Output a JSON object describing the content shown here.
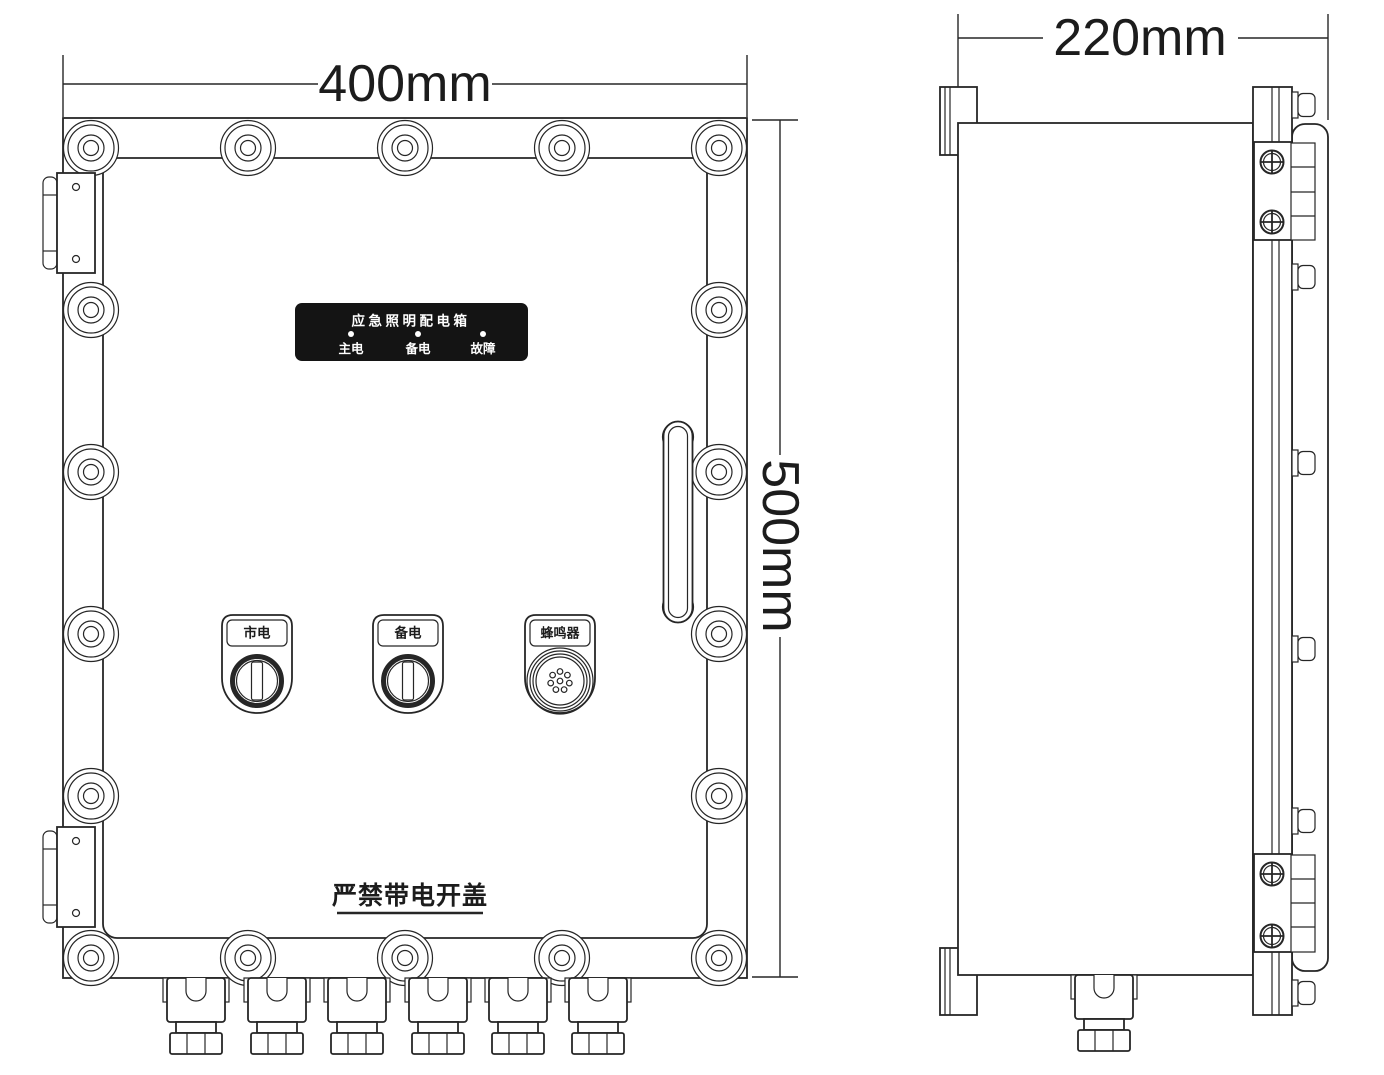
{
  "drawing": {
    "title": "emergency lighting distribution box outline drawing",
    "front_view": {
      "width_dimension": "400mm",
      "height_dimension": "500mm",
      "nameplate": {
        "title": "应急照明配电箱",
        "indicators": [
          {
            "label": "主电"
          },
          {
            "label": "备电"
          },
          {
            "label": "故障"
          }
        ]
      },
      "controls": [
        {
          "label": "市电",
          "type": "key-switch"
        },
        {
          "label": "备电",
          "type": "key-switch"
        },
        {
          "label": "蜂鸣器",
          "type": "buzzer"
        }
      ],
      "warning": "严禁带电开盖"
    },
    "side_view": {
      "depth_dimension": "220mm"
    },
    "colors": {
      "line": "#262626",
      "nameplate_bg": "#141414",
      "nameplate_text": "#ffffff"
    }
  }
}
